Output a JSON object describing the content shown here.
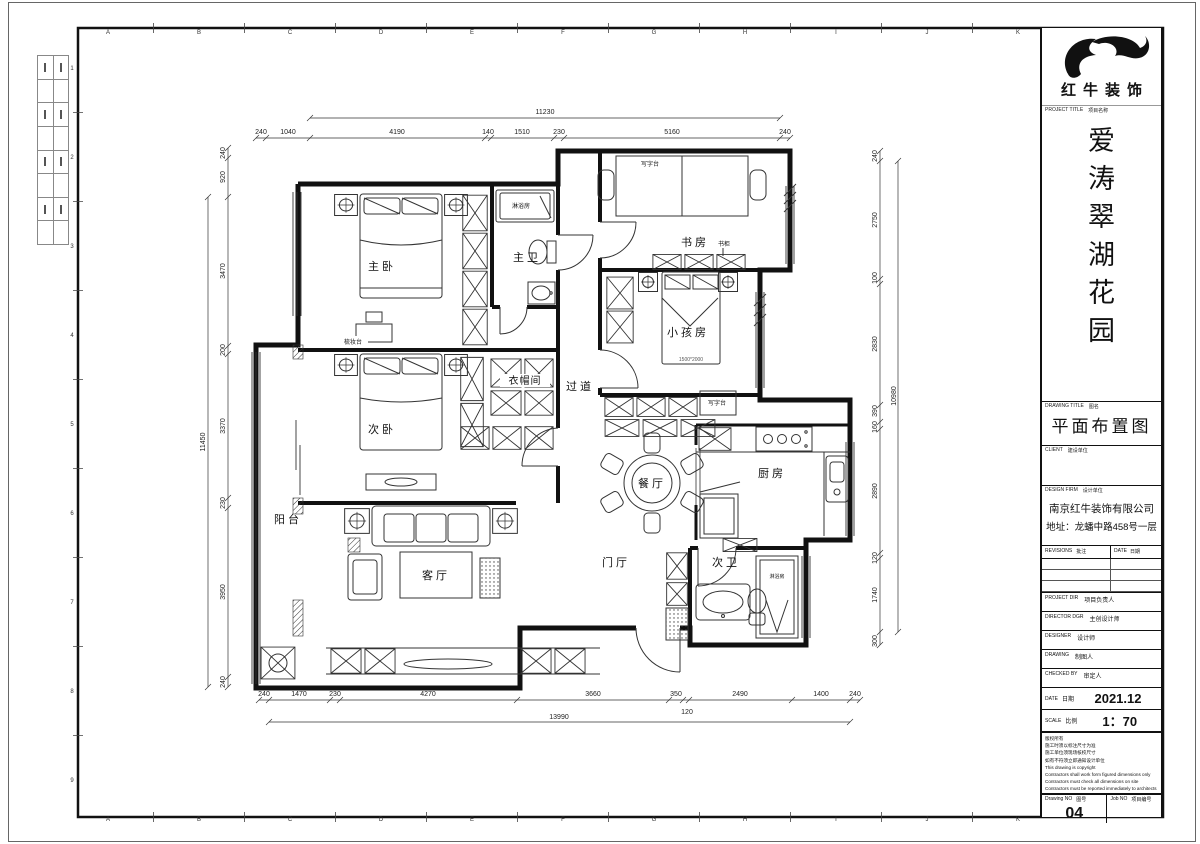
{
  "sheet": {
    "grid_letters": [
      "A",
      "B",
      "C",
      "D",
      "E",
      "F",
      "G",
      "H",
      "I",
      "J",
      "K"
    ],
    "grid_numbers": [
      "1",
      "2",
      "3",
      "4",
      "5",
      "6",
      "7",
      "8",
      "9"
    ]
  },
  "title_block": {
    "brand": "红牛装饰",
    "project_title_label_en": "PROJECT TITLE",
    "project_title_label_zh": "项目名称",
    "project_name": "爱涛翠湖花园",
    "name_chars": [
      "爱",
      "涛",
      "翠",
      "湖",
      "花",
      "园"
    ],
    "drawing_title_label_en": "DRAWING TITLE",
    "drawing_title_label_zh": "图名",
    "drawing_title": "平面布置图",
    "client_label_en": "CLIENT",
    "client_label_zh": "建设单位",
    "design_firm_label_en": "DESIGN FIRM",
    "design_firm_label_zh": "设计单位",
    "design_firm_name": "南京红牛装饰有限公司",
    "design_firm_address": "地址：龙蟠中路458号一层",
    "revisions_label_en": "REVISIONS",
    "revisions_label_zh": "批注",
    "date_col_label_en": "DATE",
    "date_col_label_zh": "日期",
    "rows": [
      {
        "en": "PROJECT DIR",
        "zh": "项目负责人"
      },
      {
        "en": "DIRECTOR DGR",
        "zh": "主创设计师"
      },
      {
        "en": "DESIGNER",
        "zh": "设计师"
      },
      {
        "en": "DRAWING",
        "zh": "制图人"
      },
      {
        "en": "CHECKED BY",
        "zh": "审定人"
      }
    ],
    "date_label_en": "DATE",
    "date_label_zh": "日期",
    "date_value": "2021.12",
    "scale_label_en": "SCALE",
    "scale_label_zh": "比例",
    "scale_value": "1：70",
    "notes": [
      "版权所有",
      "施工时须以标注尺寸为准",
      "施工单位须现场核校尺寸",
      "如有不符须立即通知设计单位",
      "This drawing is copyright",
      "Contractors shall work form figured dimensions only",
      "Contractors must check all dimensions on site",
      "Contractors must be reported immediately to architects"
    ],
    "drawing_no_label_en": "Drawing NO",
    "drawing_no_label_zh": "图号",
    "drawing_no_value": "04",
    "job_no_label_en": "Job NO",
    "job_no_label_zh": "项目编号"
  },
  "plan": {
    "labels": {
      "master_bedroom": "主卧",
      "master_bath": "主卫",
      "study": "书房",
      "kids_room": "小孩房",
      "corridor": "过道",
      "closet": "衣帽间",
      "second_bedroom": "次卧",
      "dining": "餐厅",
      "kitchen": "厨房",
      "balcony": "阳台",
      "living": "客厅",
      "foyer": "门厅",
      "second_bath": "次卫"
    },
    "annos": {
      "shower_master": "淋浴房",
      "desk_study": "写字台",
      "bookcase": "书柜",
      "desk_kids": "写字台",
      "bed_size": "1500*2000",
      "dresser": "梳妆台",
      "shower_second": "淋浴房"
    },
    "dims": {
      "top": [
        "240",
        "1040",
        "4190",
        "140",
        "1510",
        "230",
        "5160",
        "240"
      ],
      "top_overall": "11230",
      "bottom": [
        "240",
        "1470",
        "230",
        "4270",
        "3660",
        "350",
        "2490",
        "1400",
        "240"
      ],
      "bottom_inner": "120",
      "bottom_overall": "13990",
      "left": [
        "240",
        "920",
        "3470",
        "200",
        "3370",
        "230",
        "3950",
        "240"
      ],
      "left_overall": "11450",
      "right": [
        "240",
        "2750",
        "100",
        "2830",
        "390",
        "160",
        "2890",
        "120",
        "1740",
        "300"
      ],
      "right_overall": "10980"
    }
  }
}
